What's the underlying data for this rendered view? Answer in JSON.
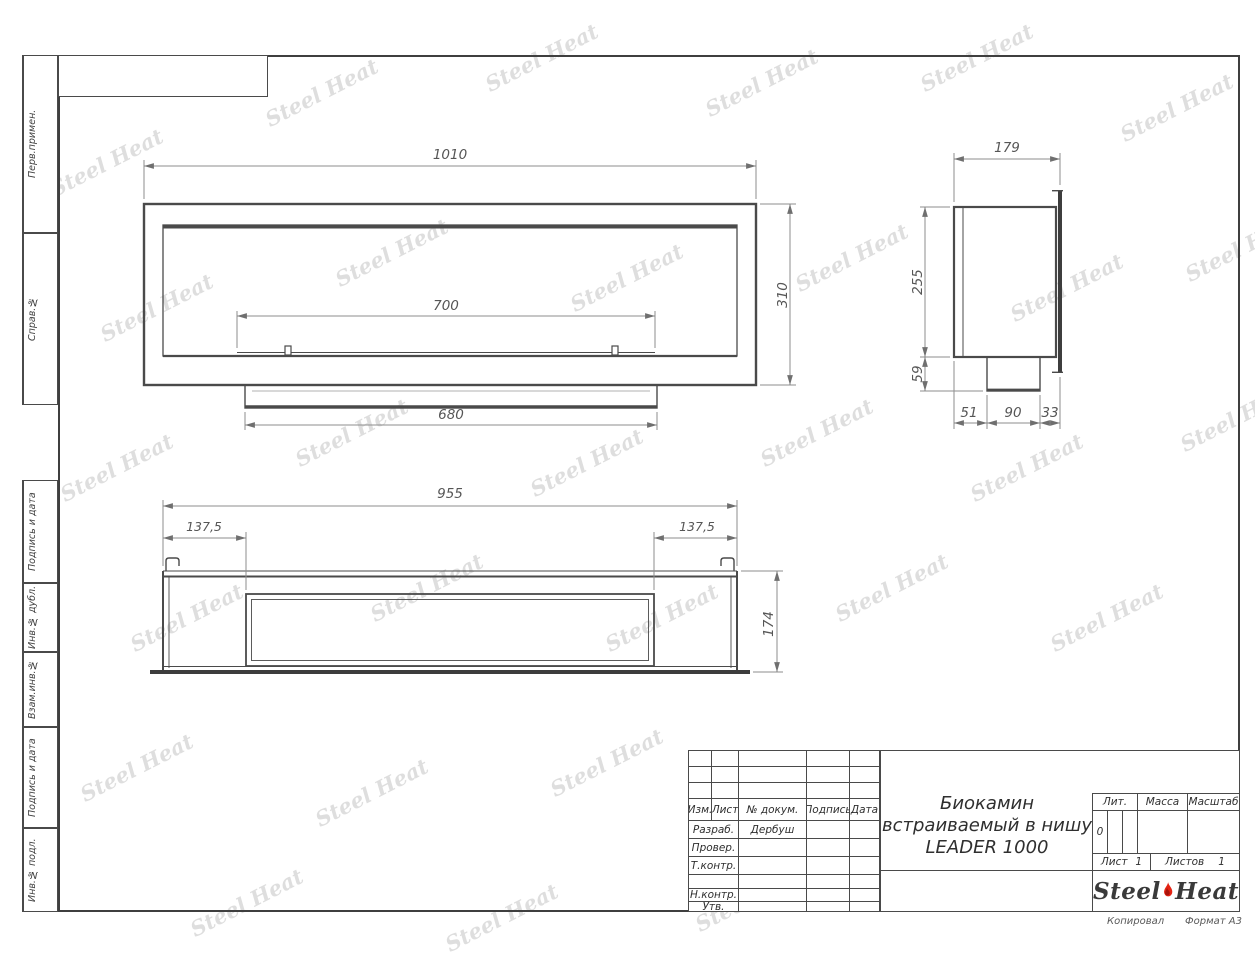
{
  "watermark": {
    "text": "Steel Heat"
  },
  "margin_labels": {
    "perv_primen": "Перв.примен.",
    "sprav_no": "Справ.№",
    "podpis_i_data_1": "Подпись и дата",
    "inv_no_dubl": "Инв.№ дубл.",
    "vzam_inv_no": "Взам.инв.№",
    "podpis_i_data_2": "Подпись и дата",
    "inv_no_podl": "Инв.№ подл."
  },
  "dims": {
    "front": {
      "width": "1010",
      "height": "310",
      "slot": "700",
      "base": "680"
    },
    "side": {
      "depth": "179",
      "height": "255",
      "base_height": "59",
      "seg1": "51",
      "seg2": "90",
      "seg3": "33"
    },
    "top": {
      "width": "955",
      "offset_left": "137,5",
      "offset_right": "137,5",
      "depth": "174"
    }
  },
  "title_block": {
    "cols": {
      "izm": "Изм.",
      "list": "Лист",
      "doc_no": "№ докум.",
      "podpis": "Подпись",
      "data": "Дата"
    },
    "roles": {
      "razrab": "Разраб.",
      "prover": "Провер.",
      "tkontr": "Т.контр.",
      "nkontr": "Н.контр.",
      "utv": "Утв."
    },
    "developer": "Дербуш",
    "title_line1": "Биокамин",
    "title_line2": "встраиваемый в нишу",
    "title_line3": "LEADER 1000",
    "lit_label": "Лит.",
    "lit_value": "0",
    "massa_label": "Масса",
    "masshtab_label": "Масштаб",
    "sheet_label": "Лист",
    "sheet_value": "1",
    "sheets_label": "Листов",
    "sheets_value": "1",
    "flame_color": "#e42313"
  },
  "logo": {
    "steel": "Steel",
    "heat": "Heat"
  },
  "footer": {
    "copied": "Копировал",
    "format": "Формат А3"
  }
}
